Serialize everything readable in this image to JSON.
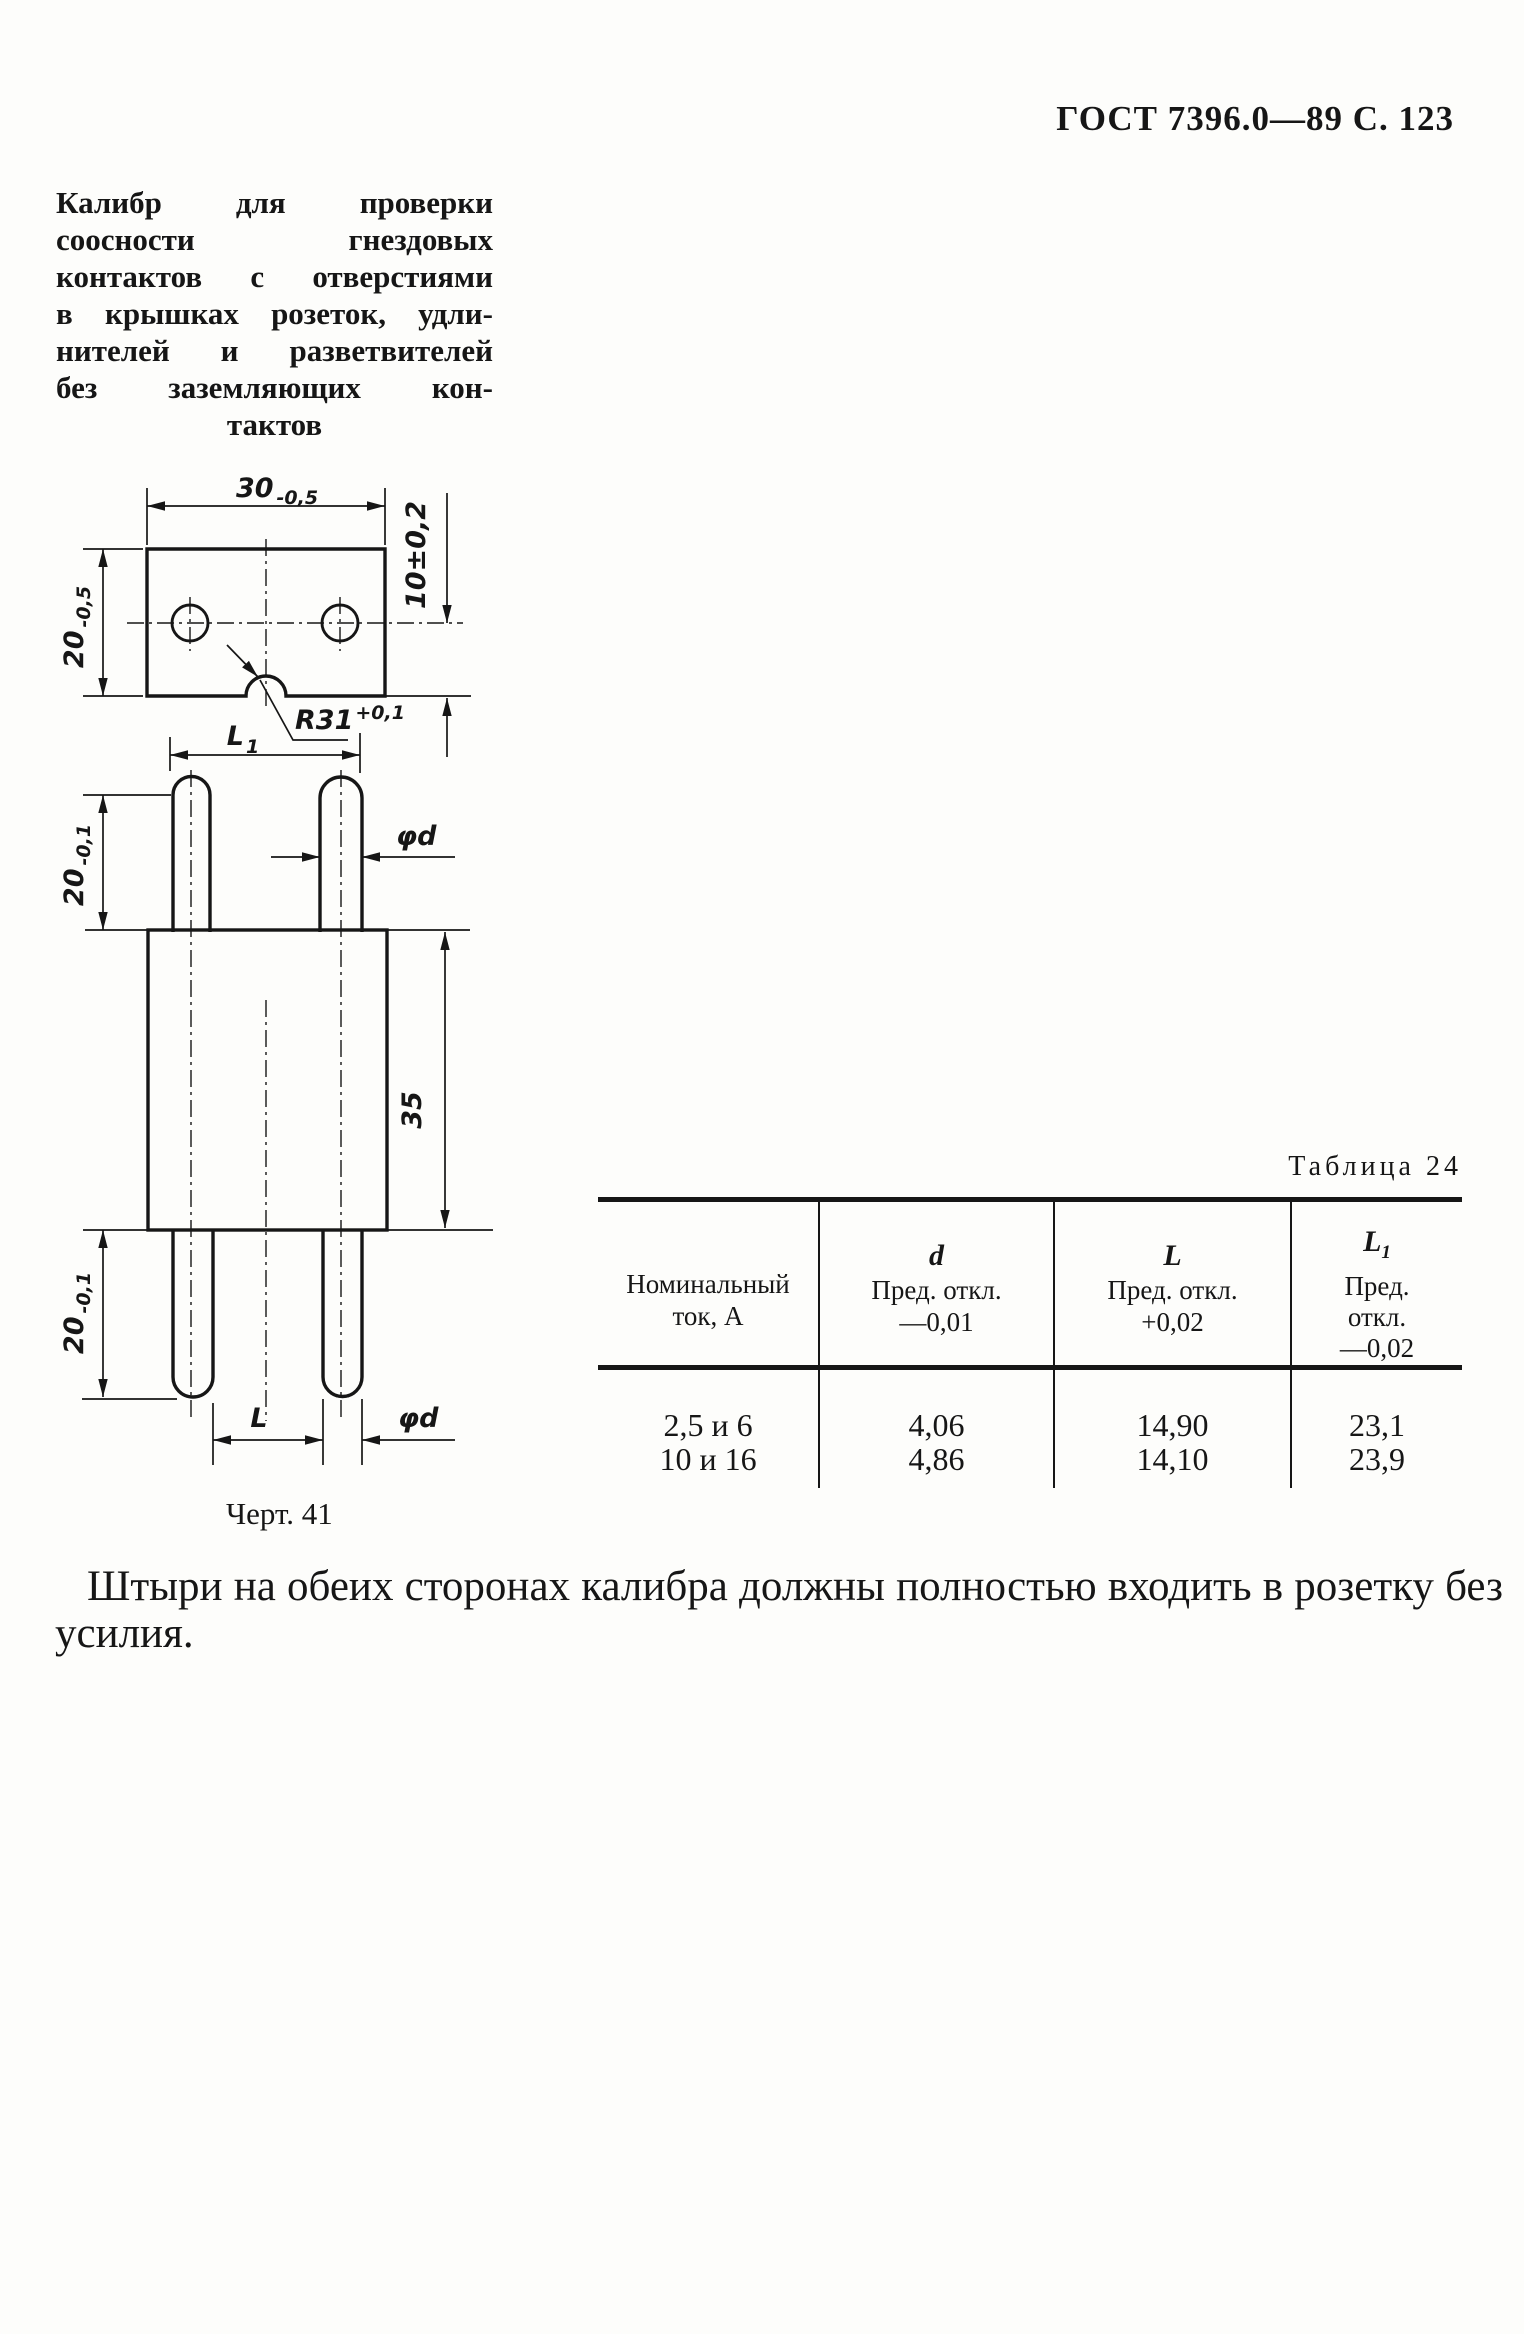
{
  "page": {
    "header": "ГОСТ 7396.0—89 С. 123",
    "intro": {
      "lines": [
        "Калибр для проверки",
        "соосности гнездовых",
        "контактов с отверстиями",
        "в крышках розеток, удли-",
        "нителей и разветвителей",
        "без заземляющих кон-",
        "тактов"
      ]
    },
    "closing": "Штыри на обеих сторонах калибра должны полностью входить в розетку без усилия."
  },
  "figure": {
    "caption": "Черт. 41",
    "labels": {
      "top_width": "30",
      "top_width_tol": "-0,5",
      "left_height": "20",
      "left_height_tol": "-0,5",
      "right_offset": "10±0,2",
      "radius": "R31",
      "radius_tol": "+0,1",
      "l1": "L",
      "l1_sub": "1",
      "pin_len_top": "20",
      "pin_len_top_tol": "-0,1",
      "pin_dia": "φd",
      "body_height": "35",
      "pin_len_bottom": "20",
      "pin_len_bottom_tol": "-0,1",
      "l": "L"
    }
  },
  "table": {
    "title": "Таблица 24",
    "columns": [
      {
        "line1": "Номинальный",
        "line2": "ток, А"
      },
      {
        "sym": "d",
        "sub": "",
        "dev1": "Пред. откл.",
        "dev2": "—0,01"
      },
      {
        "sym": "L",
        "sub": "",
        "dev1": "Пред. откл.",
        "dev2": "+0,02"
      },
      {
        "sym": "L",
        "sub": "1",
        "dev1": "Пред.",
        "dev2": "откл.",
        "dev3": "—0,02"
      }
    ],
    "rows": [
      [
        "2,5 и 6",
        "4,06",
        "14,90",
        "23,1"
      ],
      [
        "10 и 16",
        "4,86",
        "14,10",
        "23,9"
      ]
    ]
  }
}
